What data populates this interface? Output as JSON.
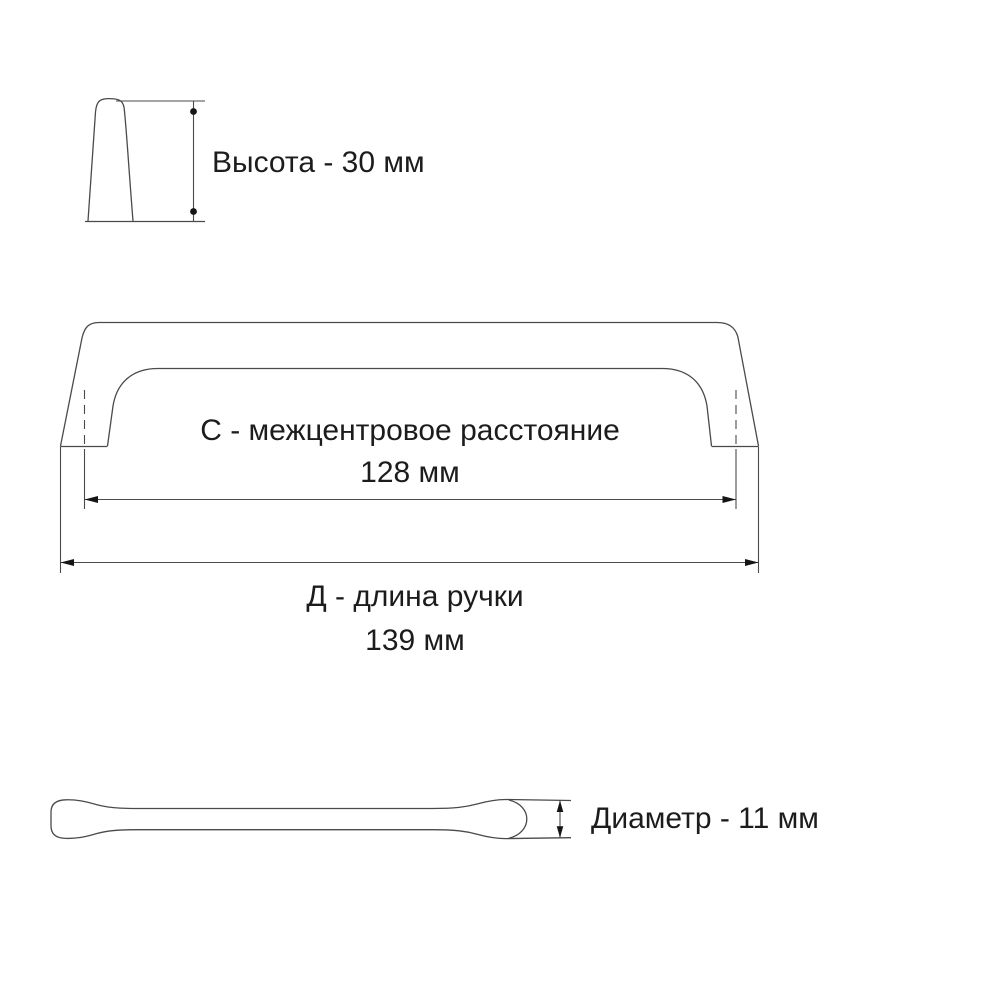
{
  "labels": {
    "height": "Высота - 30 мм",
    "center_distance_title": "С - межцентровое расстояние",
    "center_distance_value": "128 мм",
    "length_title": "Д - длина ручки",
    "length_value": "139 мм",
    "diameter": "Диаметр - 11 мм"
  },
  "dimensions_mm": {
    "height": 30,
    "center_distance": 128,
    "length": 139,
    "diameter": 11
  },
  "colors": {
    "line": "#4a4a4a",
    "arrow": "#151515",
    "text": "#1c1c1c",
    "background": "#ffffff"
  }
}
